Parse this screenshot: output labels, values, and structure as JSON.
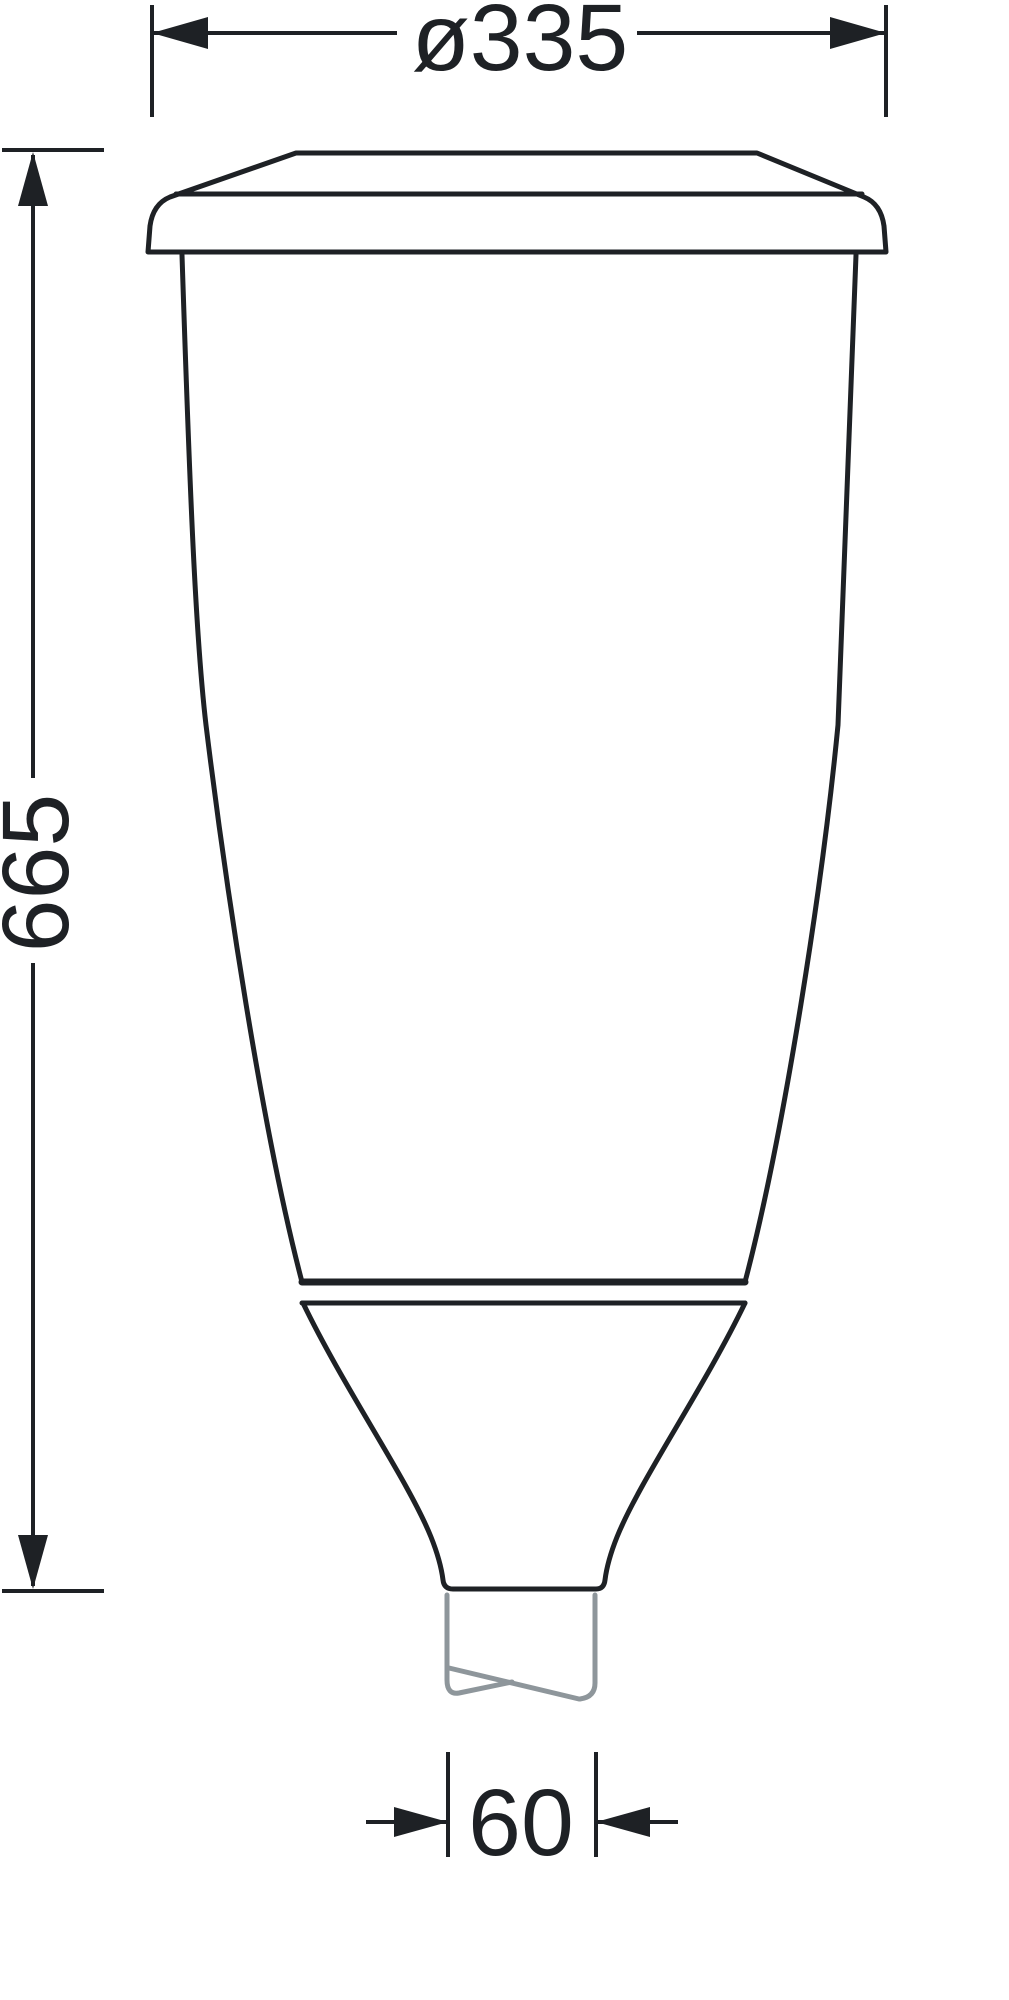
{
  "drawing": {
    "type": "technical-dimension-drawing",
    "subject": "luminaire side-view outline with pole spigot",
    "dimensions": {
      "diameter_label": "ø335",
      "height_label": "665",
      "spigot_label": "60"
    },
    "colors": {
      "line": "#1e2125",
      "spigot_gray": "#8e969b",
      "background": "#ffffff"
    }
  }
}
